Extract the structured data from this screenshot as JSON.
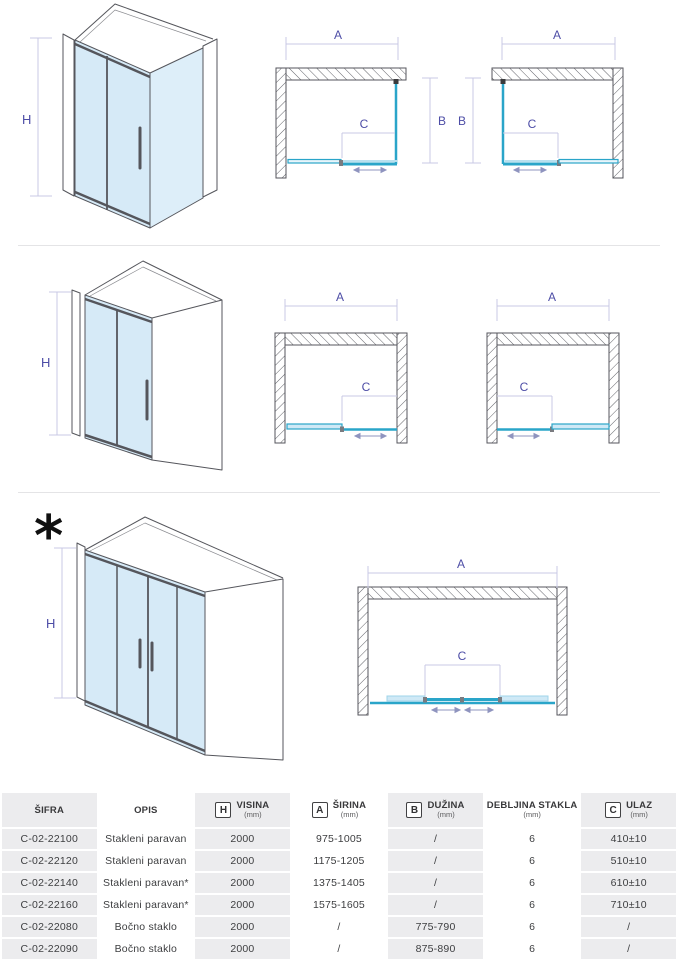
{
  "labels": {
    "h": "H",
    "a": "A",
    "b": "B",
    "c": "C"
  },
  "footnote_marker": "*",
  "colors": {
    "glass_fill": "#d6eaf7",
    "glass_side_fill": "#ddeef9",
    "frame": "#55565c",
    "plan_glass_cyan": "#2aa5c9",
    "plan_fixed_fill": "#cfe9f6",
    "dimension_line": "#c9c9e4",
    "dimension_label": "#4d4da6",
    "arrow": "#8f94bf",
    "table_gray_cell": "#ececee",
    "table_white_cell": "#ffffff",
    "table_text": "#3d3e40"
  },
  "table": {
    "headers": [
      {
        "letter": "",
        "title": "ŠIFRA",
        "unit": ""
      },
      {
        "letter": "",
        "title": "OPIS",
        "unit": ""
      },
      {
        "letter": "H",
        "title": "VISINA",
        "unit": "(mm)"
      },
      {
        "letter": "A",
        "title": "ŠIRINA",
        "unit": "(mm)"
      },
      {
        "letter": "B",
        "title": "DUŽINA",
        "unit": "(mm)"
      },
      {
        "letter": "",
        "title": "DEBLJINA STAKLA",
        "unit": "(mm)"
      },
      {
        "letter": "C",
        "title": "ULAZ",
        "unit": "(mm)"
      }
    ],
    "rows": [
      [
        "C-02-22100",
        "Stakleni paravan",
        "2000",
        "975-1005",
        "/",
        "6",
        "410±10"
      ],
      [
        "C-02-22120",
        "Stakleni paravan",
        "2000",
        "1175-1205",
        "/",
        "6",
        "510±10"
      ],
      [
        "C-02-22140",
        "Stakleni paravan*",
        "2000",
        "1375-1405",
        "/",
        "6",
        "610±10"
      ],
      [
        "C-02-22160",
        "Stakleni paravan*",
        "2000",
        "1575-1605",
        "/",
        "6",
        "710±10"
      ],
      [
        "C-02-22080",
        "Bočno staklo",
        "2000",
        "/",
        "775-790",
        "6",
        "/"
      ],
      [
        "C-02-22090",
        "Bočno staklo",
        "2000",
        "/",
        "875-890",
        "6",
        "/"
      ]
    ]
  }
}
